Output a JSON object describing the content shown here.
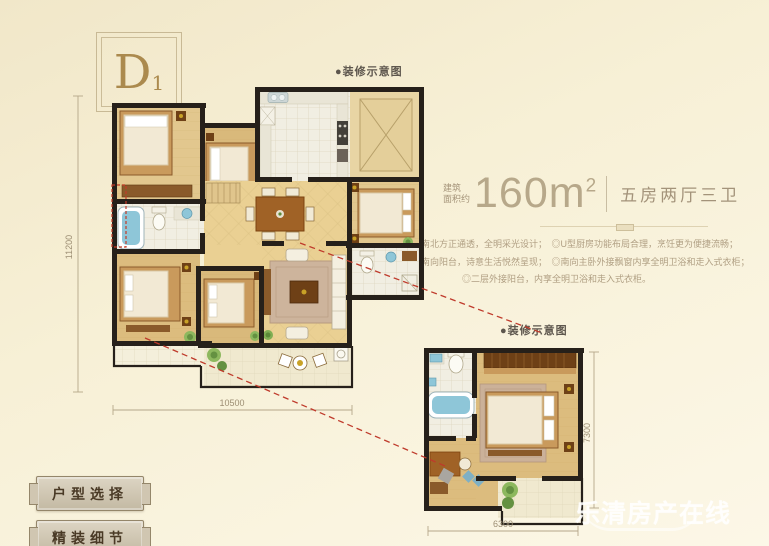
{
  "unit_badge": {
    "letter": "D",
    "sub": "1"
  },
  "labels": {
    "deco_top": "●装修示意图",
    "deco_bottom": "●装修示意图"
  },
  "area_info": {
    "prefix_line1": "建筑",
    "prefix_line2": "面积约",
    "value": "160m",
    "sup": "2",
    "layout": "五房两厅三卫"
  },
  "features": {
    "line1": "◎四开间朝南，南北方正通透，全明采光设计；　◎U型厨房功能布局合理，烹饪更为便捷流畅；",
    "line2": "◎客厅连接超大南向阳台，诗意生活悦然呈现；　◎南向主卧外接飘窗内享全明卫浴和走入式衣柜；",
    "line3": "◎二层外接阳台，内享全明卫浴和走入式衣柜。"
  },
  "dimensions": {
    "main_left": "11200",
    "main_bottom": "10500",
    "detail_right": "7300",
    "detail_bottom": "6300"
  },
  "buttons": {
    "floor_plan_select": "户型选择",
    "fine_decor_detail": "精装细节"
  },
  "watermark": {
    "text": "乐清房产在线"
  },
  "colors": {
    "background": "#f7f0d6",
    "wall": "#26201a",
    "wood_floor": "#dcbc7e",
    "tile": "#f1eee2",
    "fixture_blue": "#8ec6d8",
    "furniture_brown": "#8a5a2a",
    "leader_red": "#bf3a2b",
    "text_brown": "#a3937a",
    "badge_gold": "#ab8a4e"
  }
}
